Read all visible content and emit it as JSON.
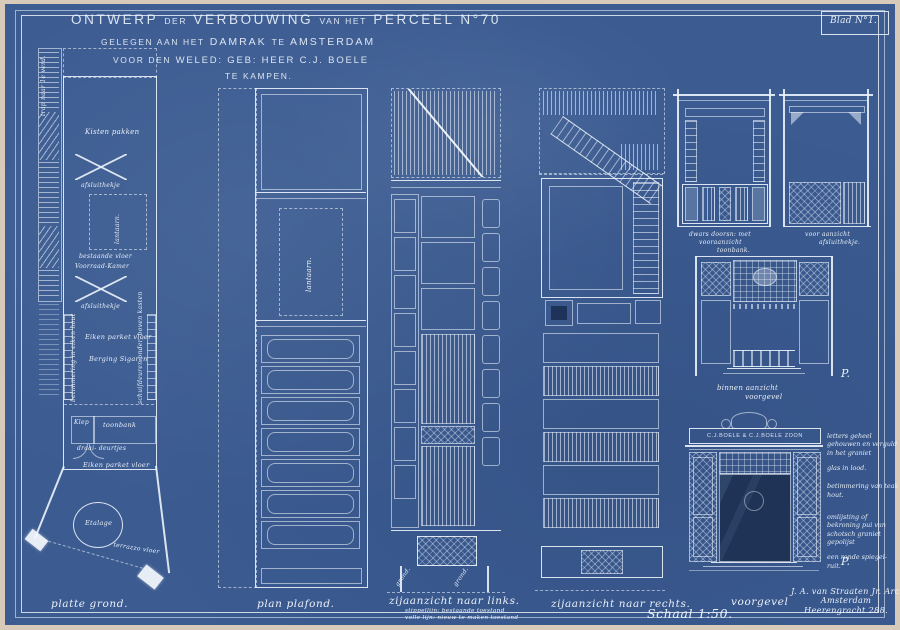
{
  "colors": {
    "paper": "#d7cab8",
    "blueprint": "#3b5b91",
    "ink": "#ecf3fb",
    "dark_opening": "#1f3356"
  },
  "sheet": {
    "blad": "Blad N°1.",
    "scale_label": "Schaal 1:50."
  },
  "title": {
    "l1_a": "ONTWERP",
    "l1_b": "DER",
    "l1_c": "VERBOUWING",
    "l1_d": "VAN HET",
    "l1_e": "PERCEEL N°70",
    "l2_a": "GELEGEN AAN HET",
    "l2_b": "DAMRAK",
    "l2_c": "TE",
    "l2_d": "AMSTERDAM",
    "l3_a": "VOOR DEN",
    "l3_b": "WELED: GEB: HEER",
    "l3_c": "C.J. BOELE",
    "l4": "TE KAMPEN."
  },
  "floor_plan": {
    "caption": "platte grond.",
    "trap": "trap naar 1e verd.",
    "kisten": "Kisten pakken",
    "afsluithekje_1": "afsluithekje",
    "lantaarn": "lantaarn.",
    "bestaande_vloer": "bestaande vloer",
    "voorraad_kamer": "Voorraad-Kamer",
    "afsluithekje_2": "afsluithekje",
    "betimmering": "betimmering in eiken hout",
    "eiken_parket_1": "Eiken parket vloer",
    "berging": "Berging Sigaren",
    "schuifdeuren": "schuifdeuren onder, boven kasten",
    "klep": "Klep",
    "toonbank": "toonbank",
    "draaideurtjes": "draai- deurtjes",
    "eiken_parket_2": "Eiken parket vloer",
    "etalage": "Etalage",
    "terrazzo": "terrazzo vloer"
  },
  "ceiling_plan": {
    "caption": "plan plafond.",
    "lantaarn": "lantaarn."
  },
  "left_elevation": {
    "caption": "zijaanzicht naar links.",
    "note_1": "stippellijn: bestaande toestand",
    "note_2": "volle lijn: nieuw te maken toestand",
    "grond_1": "grond.",
    "grond_2": "grond."
  },
  "right_elevation": {
    "caption": "zijaanzicht naar rechts."
  },
  "details": {
    "toonbank_caption_1": "dwars doorsn: met",
    "toonbank_caption_2": "vooraanzicht",
    "toonbank_caption_3": "toonbank.",
    "hekje_caption_1": "voor aanzicht",
    "hekje_caption_2": "afsluithekje.",
    "binnen_caption_1": "binnen aanzicht",
    "binnen_caption_2": "voorgevel",
    "p_mark_1": "P.",
    "sign_text": "C.J.BOELE & C.J.BOELE ZOON",
    "gevel_note_1": "letters geheel gehouwen en verguld in het graniet",
    "gevel_note_2": "glas in lood.",
    "gevel_note_3": "betimmering van teak hout.",
    "gevel_note_4": "omlijsting of bekroning pui van schotsch graniet gepolijst",
    "gevel_note_5": "een ronde spiegel- ruit.",
    "p_mark_2": "P.",
    "voorgevel_caption": "voorgevel"
  },
  "architect": {
    "line_1": "J. A. van Straaten Jr. Arch.",
    "line_2": "Amsterdam",
    "line_3": "Heerengracht 288."
  }
}
